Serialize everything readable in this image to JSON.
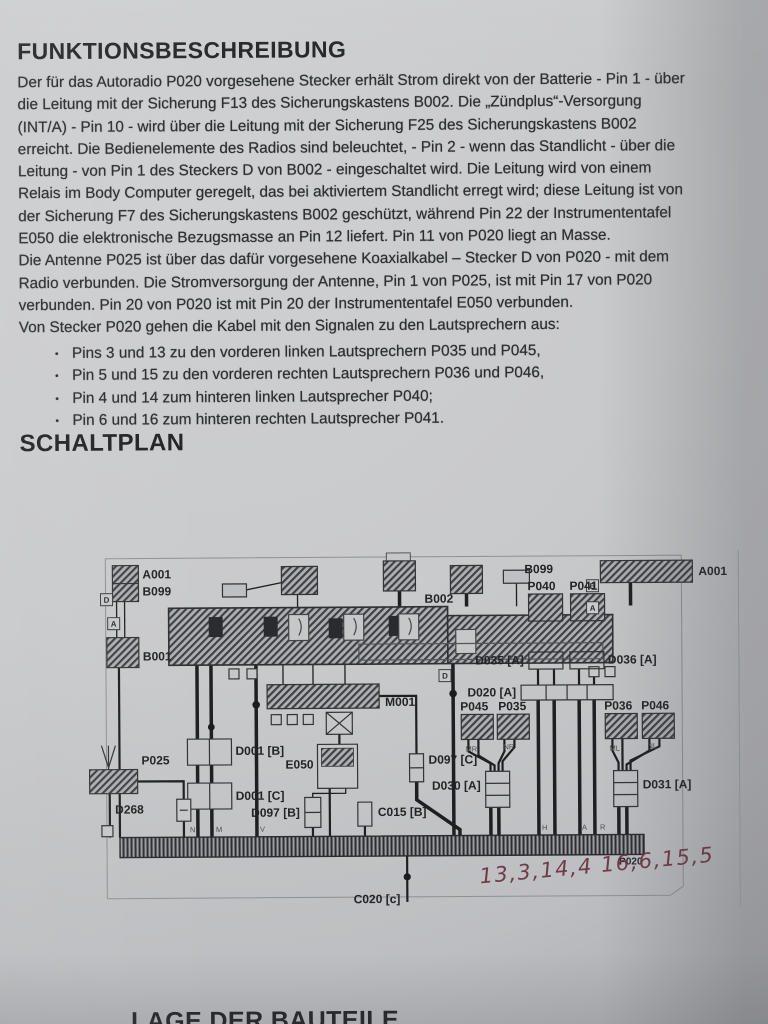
{
  "page": {
    "title1": "FUNKTIONSBESCHREIBUNG",
    "title2": "SCHALTPLAN",
    "bottom_cut_heading": "LAGE DER BAUTEILE"
  },
  "description": {
    "lines": [
      "Der für das Autoradio P020 vorgesehene Stecker erhält Strom direkt von der Batterie - Pin 1 - über",
      "die Leitung mit der Sicherung F13 des Sicherungskastens B002. Die „Zündplus“-Versorgung",
      "(INT/A) - Pin 10 - wird über die Leitung mit der Sicherung F25 des Sicherungskastens B002",
      "erreicht. Die Bedienelemente des Radios sind beleuchtet, - Pin 2 - wenn das Standlicht - über die",
      "Leitung - von Pin 1 des Steckers D von B002 - eingeschaltet wird. Die Leitung wird von einem",
      "Relais im Body Computer geregelt, das bei aktiviertem Standlicht erregt wird; diese Leitung ist von",
      "der Sicherung F7 des Sicherungskastens B002 geschützt, während Pin 22 der Instrumententafel",
      "E050 die elektronische Bezugsmasse an Pin 12 liefert. Pin 11 von P020 liegt an Masse.",
      "Die Antenne P025 ist über das dafür vorgesehene Koaxialkabel – Stecker D von P020 - mit dem",
      "Radio verbunden. Die Stromversorgung der Antenne, Pin 1 von P025, ist mit Pin 17 von P020",
      "verbunden. Pin 20 von P020 ist mit Pin 20 der Instrumententafel E050 verbunden.",
      "Von Stecker P020 gehen die Kabel mit den Signalen zu den Lautsprechern aus:"
    ]
  },
  "bullets": [
    "Pins 3 und 13 zu den vorderen linken Lautsprechern P035 und P045,",
    "Pin 5 und 15 zu den vorderen rechten Lautsprechern P036 und P046,",
    "Pin 4 und 14 zum hinteren linken Lautsprecher P040;",
    "Pin 6 und 16 zum hinteren rechten Lautsprecher P041."
  ],
  "diagram": {
    "labels": {
      "a001_tl": "A001",
      "b099_tl": "B099",
      "b099_top": "B099",
      "a001_top": "A001",
      "b002": "B002",
      "b001": "B001",
      "m001": "M001",
      "e050": "E050",
      "d001_b": "D001 [B]",
      "d001_c": "D001 [C]",
      "p025": "P025",
      "d268": "D268",
      "d097_b": "D097 [B]",
      "d097_c": "D097 [C]",
      "c015_b": "C015 [B]",
      "c020_c": "C020 [c]",
      "p040": "P040",
      "p041": "P041",
      "d035_a": "D035 [A]",
      "d036_a": "D036 [A]",
      "d020_a": "D020 [A]",
      "p045": "P045",
      "p035": "P035",
      "p036": "P036",
      "p046": "P046",
      "d030_a": "D030 [A]",
      "d031_a": "D031 [A]",
      "p020": "P020"
    },
    "handwriting": "13,3,14,4 16,6,15,5",
    "tags": [
      "D",
      "A",
      "B",
      "A",
      "D"
    ],
    "wire_marks": [
      "MR",
      "NR",
      "ML",
      "NL",
      "N",
      "M",
      "V",
      "H",
      "A",
      "R"
    ]
  },
  "colors": {
    "paper": "#c8c9cb",
    "ink": "#2d2e31",
    "handwriting": "#6f3b46"
  }
}
